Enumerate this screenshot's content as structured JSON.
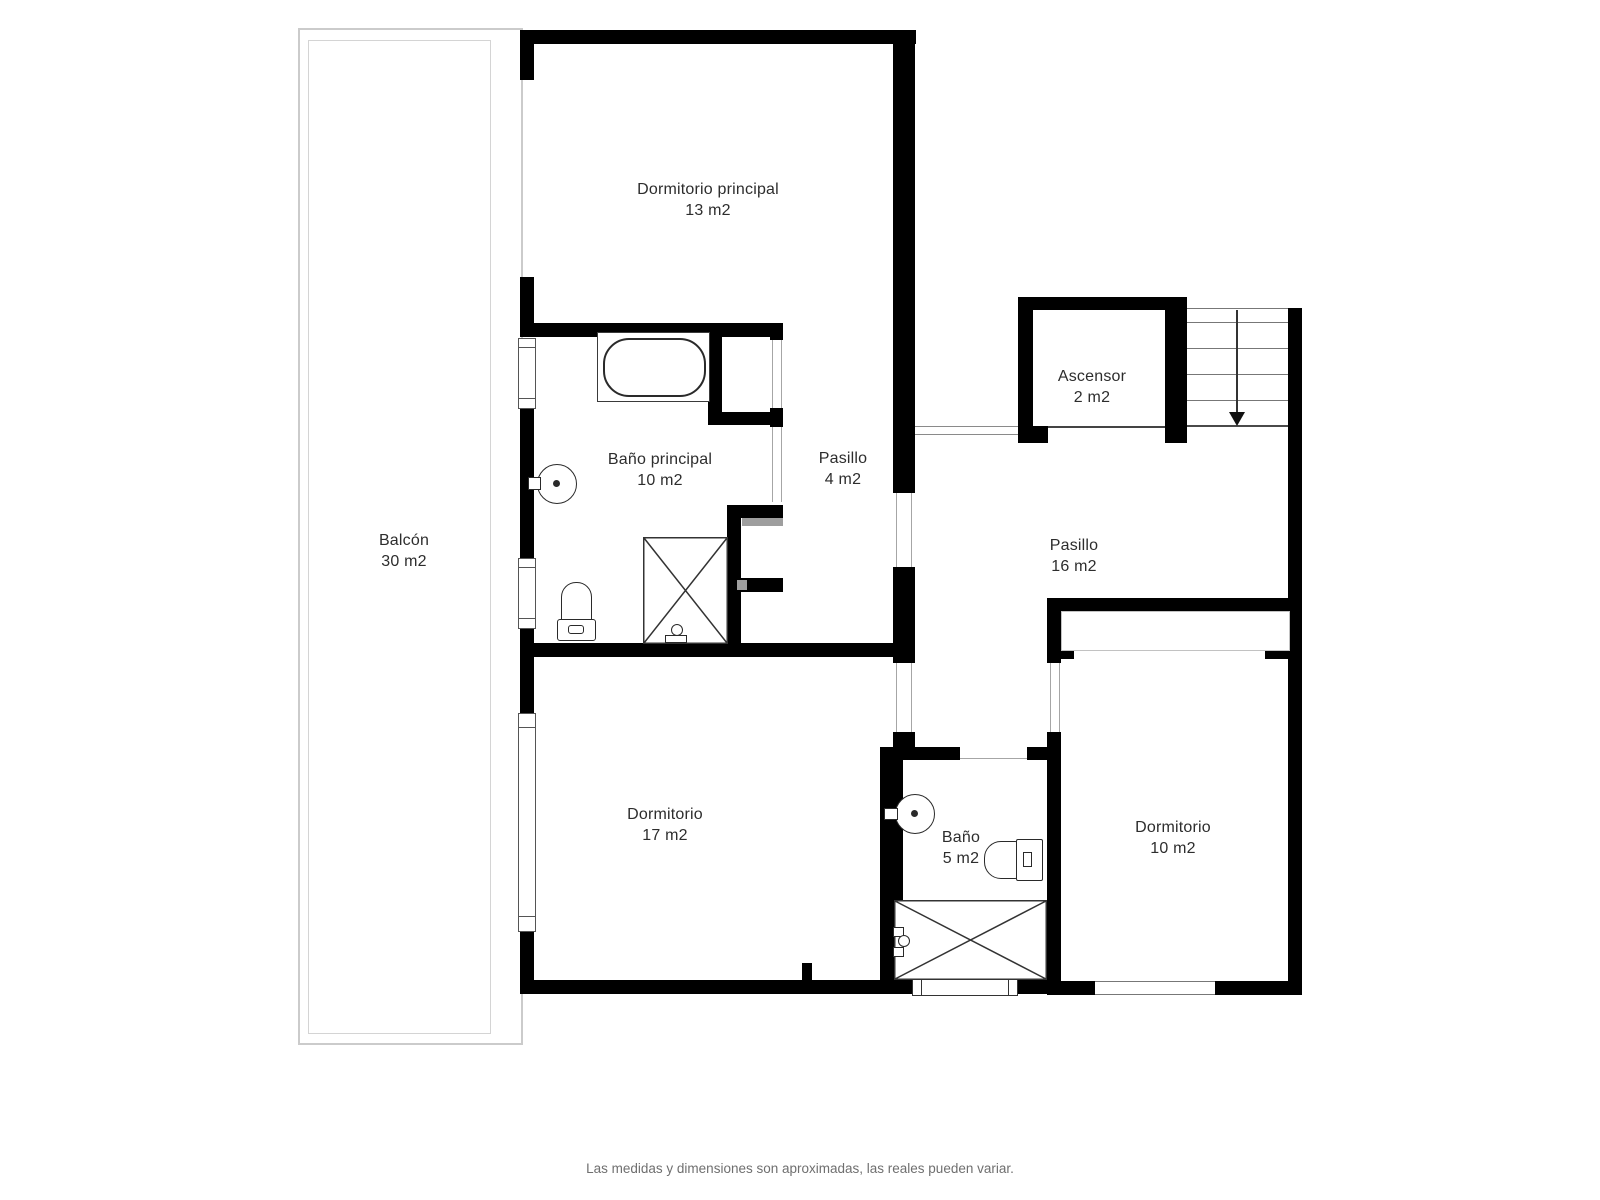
{
  "rooms": {
    "dormitorio_principal": {
      "name": "Dormitorio principal",
      "area": "13 m2"
    },
    "banyo_principal": {
      "name": "Baño principal",
      "area": "10 m2"
    },
    "pasillo_4": {
      "name": "Pasillo",
      "area": "4 m2"
    },
    "ascensor": {
      "name": "Ascensor",
      "area": "2 m2"
    },
    "pasillo_16": {
      "name": "Pasillo",
      "area": "16 m2"
    },
    "balcon": {
      "name": "Balcón",
      "area": "30 m2"
    },
    "dormitorio_17": {
      "name": "Dormitorio",
      "area": "17 m2"
    },
    "banyo_5": {
      "name": "Baño",
      "area": "5 m2"
    },
    "dormitorio_10": {
      "name": "Dormitorio",
      "area": "10 m2"
    }
  },
  "footer": {
    "disclaimer": "Las medidas y dimensiones son aproximadas, las reales pueden variar."
  },
  "icons": {
    "stairs_direction": "arrow-down"
  },
  "colors": {
    "wall": "#000000",
    "thin_line": "#8a8a8a",
    "balcony_line": "#cbcbcb",
    "label_text": "#2d2d2d",
    "footer_text": "#6f6f6f"
  }
}
